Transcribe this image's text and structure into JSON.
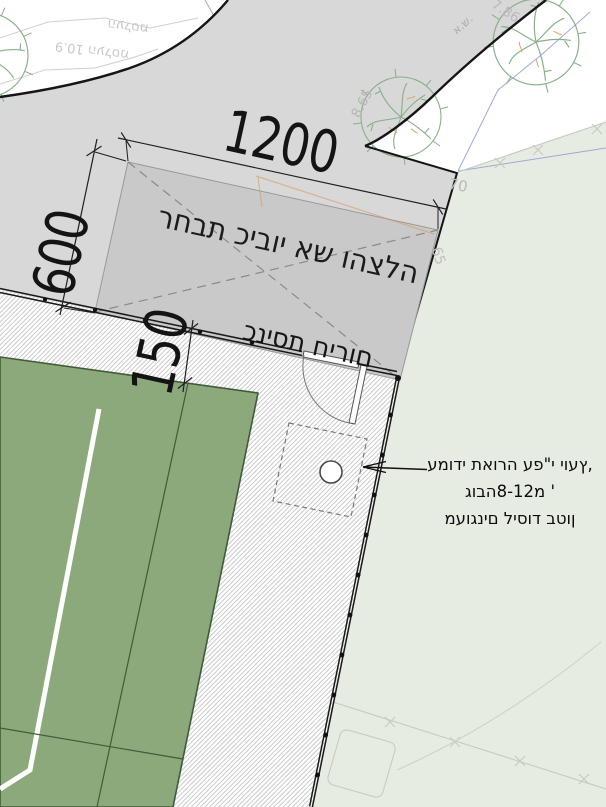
{
  "drawing": {
    "dimensions": {
      "top": "1200",
      "left": "600",
      "path": "150"
    },
    "labels": {
      "fire_rescue": "רחבת כיבוי אש והצלה",
      "emergency_entrance": "כניסת חירום"
    },
    "note": {
      "line1": "עמודי תאורה עפ\"י יועץ,",
      "line2": "גובה8-12מ '",
      "line3": "מעוגנים ליסוד בטון"
    },
    "survey": {
      "rock_wall_top": "מסלעה",
      "rock_wall_bottom": "מסלעה 10.9",
      "spot_786": "7.86",
      "spot_865": "8.65",
      "spot_70": "70",
      "spot_65": "65",
      "marker_as": "א.ש."
    },
    "colors": {
      "road_gray": "#d8d8d8",
      "fire_pad_gray": "#c9c9c9",
      "field_green": "#8ba97b",
      "area_light_green": "#e7ece3",
      "tree_outline_green": "#86b188",
      "utility_orange": "#d39a57",
      "survey_blue": "#a0a8d8",
      "line_black": "#151515"
    }
  }
}
